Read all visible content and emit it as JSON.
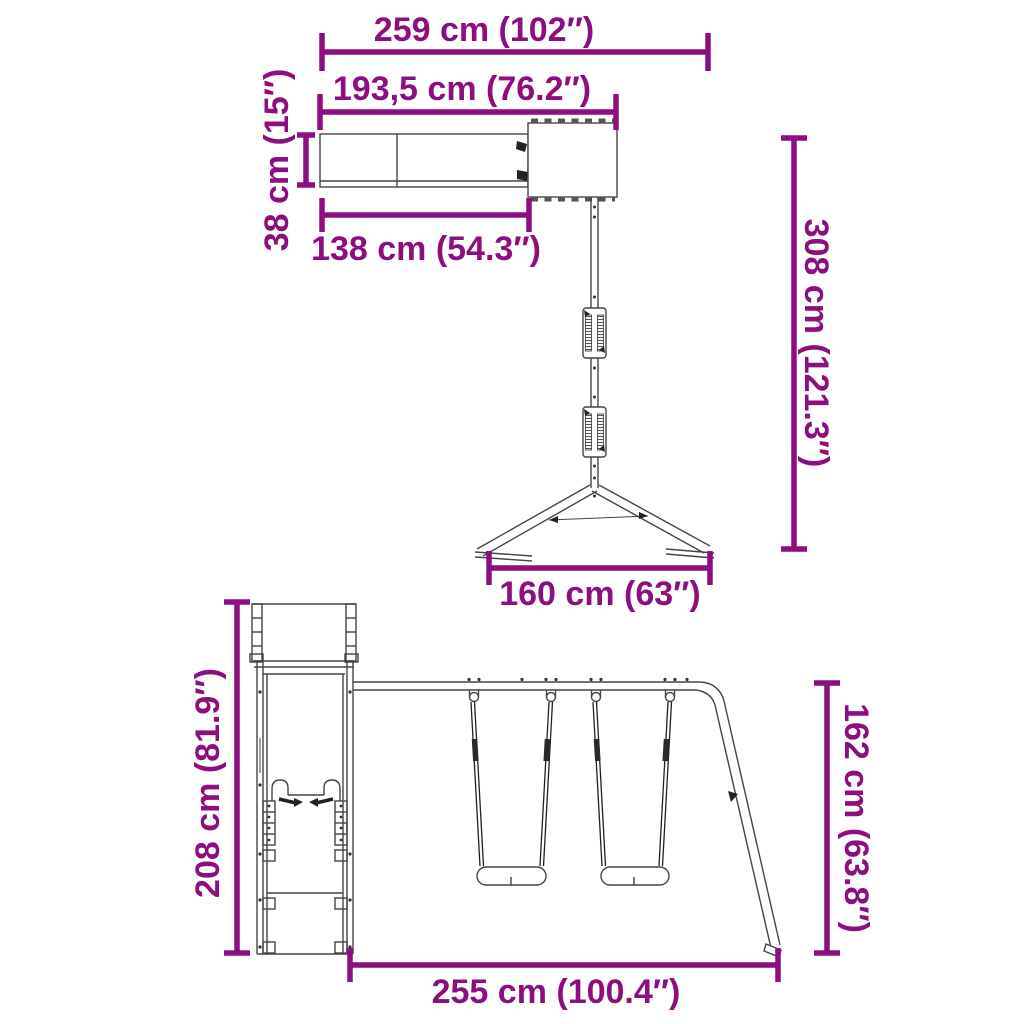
{
  "colors": {
    "dimension": "#8d0e7e",
    "drawing": "#454545",
    "background": "#ffffff"
  },
  "dimensions": {
    "total_width": "259 cm (102″)",
    "upper_length": "193,5 cm (76.2″)",
    "slide_width": "38 cm (15″)",
    "slide_length": "138 cm (54.3″)",
    "total_depth": "308 cm (121.3″)",
    "aframe_spread": "160 cm (63″)",
    "tower_height": "208 cm (81.9″)",
    "swing_frame_height": "162 cm (63.8″)",
    "base_length": "255 cm (100.4″)"
  }
}
